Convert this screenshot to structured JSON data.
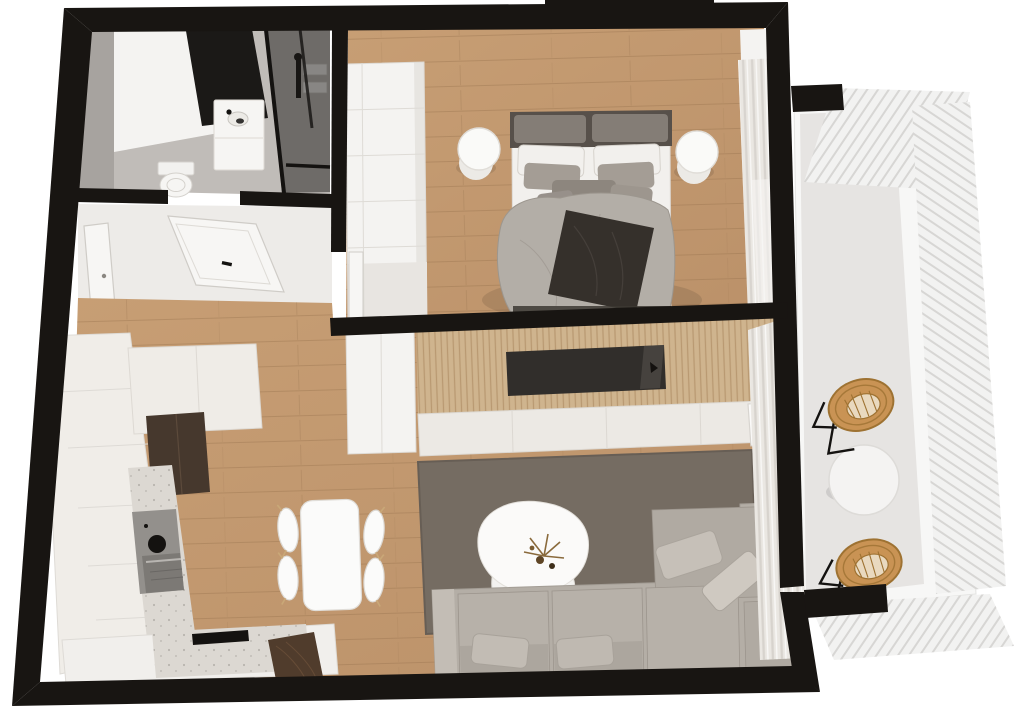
{
  "scene": {
    "kind": "3d-floor-plan-render",
    "view": "top-down axonometric apartment plan with balcony"
  },
  "palette": {
    "wall": "#181512",
    "woodA": "#bb9169",
    "woodB": "#c79e74",
    "plankLine": "#96714c",
    "hallFloor": "#edebe8",
    "concrete": "#c0bcb8",
    "concreteDark": "#a7a39f",
    "whiteFace": "#f4f3f1",
    "cream": "#efece7",
    "creamDark": "#ddd9d3",
    "terrazzo": "#dcd8d2",
    "speckle": "#b9b5af",
    "darkCabinet": "#46382d",
    "darkWood": "#503c2c",
    "appliance": "#93908c",
    "applianceDark": "#7c7975",
    "blackDetail": "#141210",
    "glass": "#1b1917",
    "slatWood": "#cfb48e",
    "slatLine": "#b29068",
    "tvBlack": "#312e2b",
    "console": "#ece9e4",
    "rug": "#756c62",
    "rugEdge": "#675e55",
    "sofa": "#b4aea6",
    "sofaCushion": "#b7b1a9",
    "sofaDark": "#9c958d",
    "sofaLight": "#c3bdb5",
    "bedLinen": "#f2f0ed",
    "pillowGray": "#a49d95",
    "pillowDark": "#8d867e",
    "duvet": "#b3aea7",
    "duvetLine": "#9c968e",
    "throw": "#35302b",
    "headboard": "#57504a",
    "headboardPad": "#847d76",
    "curtain": "#eae7e2",
    "curtainLine": "#d3cfc9",
    "balconyFloor": "#e6e4e2",
    "balustrade": "#f2f2f1",
    "balustradeLine": "#d7d6d4",
    "rattan": "#c99354",
    "rattanDark": "#9e7232",
    "shadow": "rgba(0,0,0,0.10)"
  },
  "rooms": {
    "bathroom": {
      "label": "Bathroom"
    },
    "hallway": {
      "label": "Hallway"
    },
    "bedroom": {
      "label": "Bedroom"
    },
    "living": {
      "label": "Living room"
    },
    "kitchen": {
      "label": "Kitchen and dining"
    },
    "balcony": {
      "label": "Balcony"
    }
  },
  "furniture": {
    "bed": "Double bed",
    "wardrobe": "Wardrobe",
    "nightstand": "Round nightstand",
    "sofa": "Corner sofa",
    "rug": "Area rug",
    "coffee_table": "Organic coffee table",
    "tv": "Recessed TV in slatted wall",
    "console": "Media console",
    "art": "Leaning art print",
    "dining_table": "Dining table",
    "dining_chair": "Dining chair",
    "tall_units": "Tall kitchen units",
    "counter": "Kitchen counter",
    "oven": "Oven and cooktop",
    "hob": "Black hob strip",
    "vanity": "Bathroom vanity",
    "toilet": "Toilet",
    "shower": "Glass shower",
    "mirror": "Dark mirror panel",
    "entry_door": "Entry door",
    "bathroom_door": "Bathroom door",
    "bedroom_door": "Bedroom door",
    "curtains": "Curtains",
    "balcony_table": "Round balcony table",
    "rattan_chair": "Rattan chair",
    "balustrade": "Slatted balustrade"
  }
}
